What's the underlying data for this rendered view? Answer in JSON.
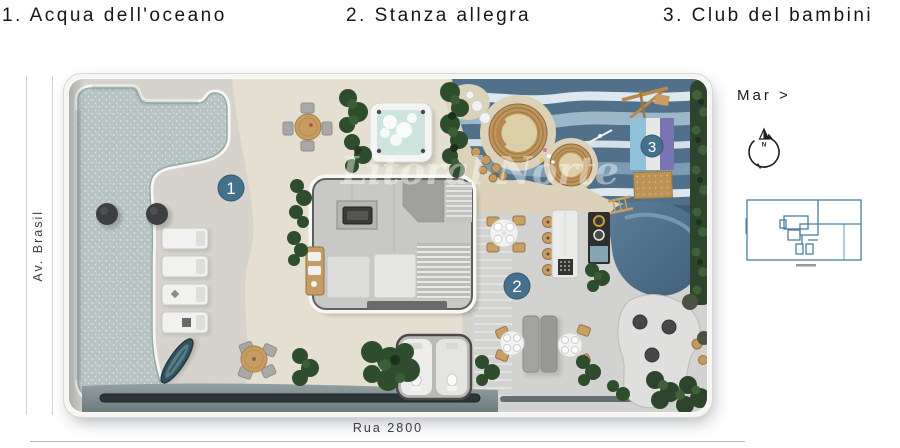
{
  "header": {
    "items": [
      {
        "label": "1. Acqua dell'oceano"
      },
      {
        "label": "2. Stanza allegra"
      },
      {
        "label": "3. Club del bambini"
      }
    ]
  },
  "plan": {
    "badges": [
      {
        "number": "1",
        "area": "ocean water pool"
      },
      {
        "number": "2",
        "area": "happy room terrace"
      },
      {
        "number": "3",
        "area": "kids club"
      }
    ],
    "watermark": "Litoral Norte"
  },
  "streets": {
    "left": "Av. Brasil",
    "bottom": "Rua 2800"
  },
  "sidebar": {
    "sea_label": "Mar >",
    "compass_north": "N"
  },
  "colors": {
    "badge": "#46718d",
    "minimap_line": "#4a7fa0",
    "pool_water": "#b7c3c3",
    "kids_blue_dark": "#51708a",
    "sand": "#e4dfd0"
  }
}
